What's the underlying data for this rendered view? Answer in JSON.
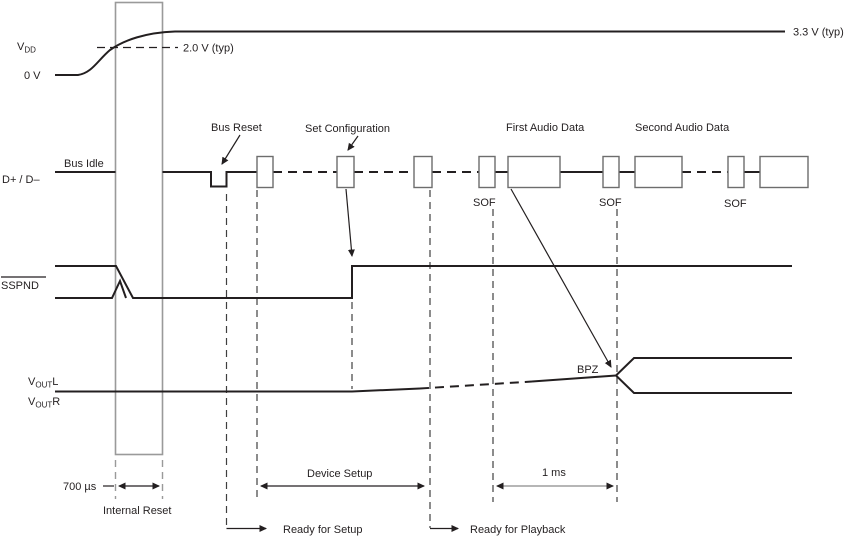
{
  "colors": {
    "ink": "#231f20",
    "grey_lines": "#9a9a9a",
    "packet_box_stroke": "#6d6d6d",
    "background": "#ffffff"
  },
  "power": {
    "vdd_letter": "V",
    "vdd_sub": "DD",
    "zero_volts": "0 V",
    "threshold": "2.0 V (typ)",
    "supply": "3.3 V (typ)"
  },
  "usb": {
    "signal_label": "D+ / D–",
    "bus_idle": "Bus Idle",
    "bus_reset": "Bus Reset",
    "set_configuration": "Set Configuration",
    "first_audio_data": "First Audio Data",
    "second_audio_data": "Second Audio Data",
    "sof_1": "SOF",
    "sof_2": "SOF",
    "sof_3": "SOF"
  },
  "suspend": {
    "signal_label": "SSPND"
  },
  "output": {
    "v_letter": "V",
    "v_sub": "OUT",
    "left_channel": "L",
    "right_channel": "R",
    "bpz": "BPZ"
  },
  "timing": {
    "reset_width": "700 µs",
    "internal_reset": "Internal Reset",
    "device_setup": "Device Setup",
    "one_ms": "1 ms",
    "ready_for_setup": "Ready for Setup",
    "ready_for_playback": "Ready for Playback"
  }
}
